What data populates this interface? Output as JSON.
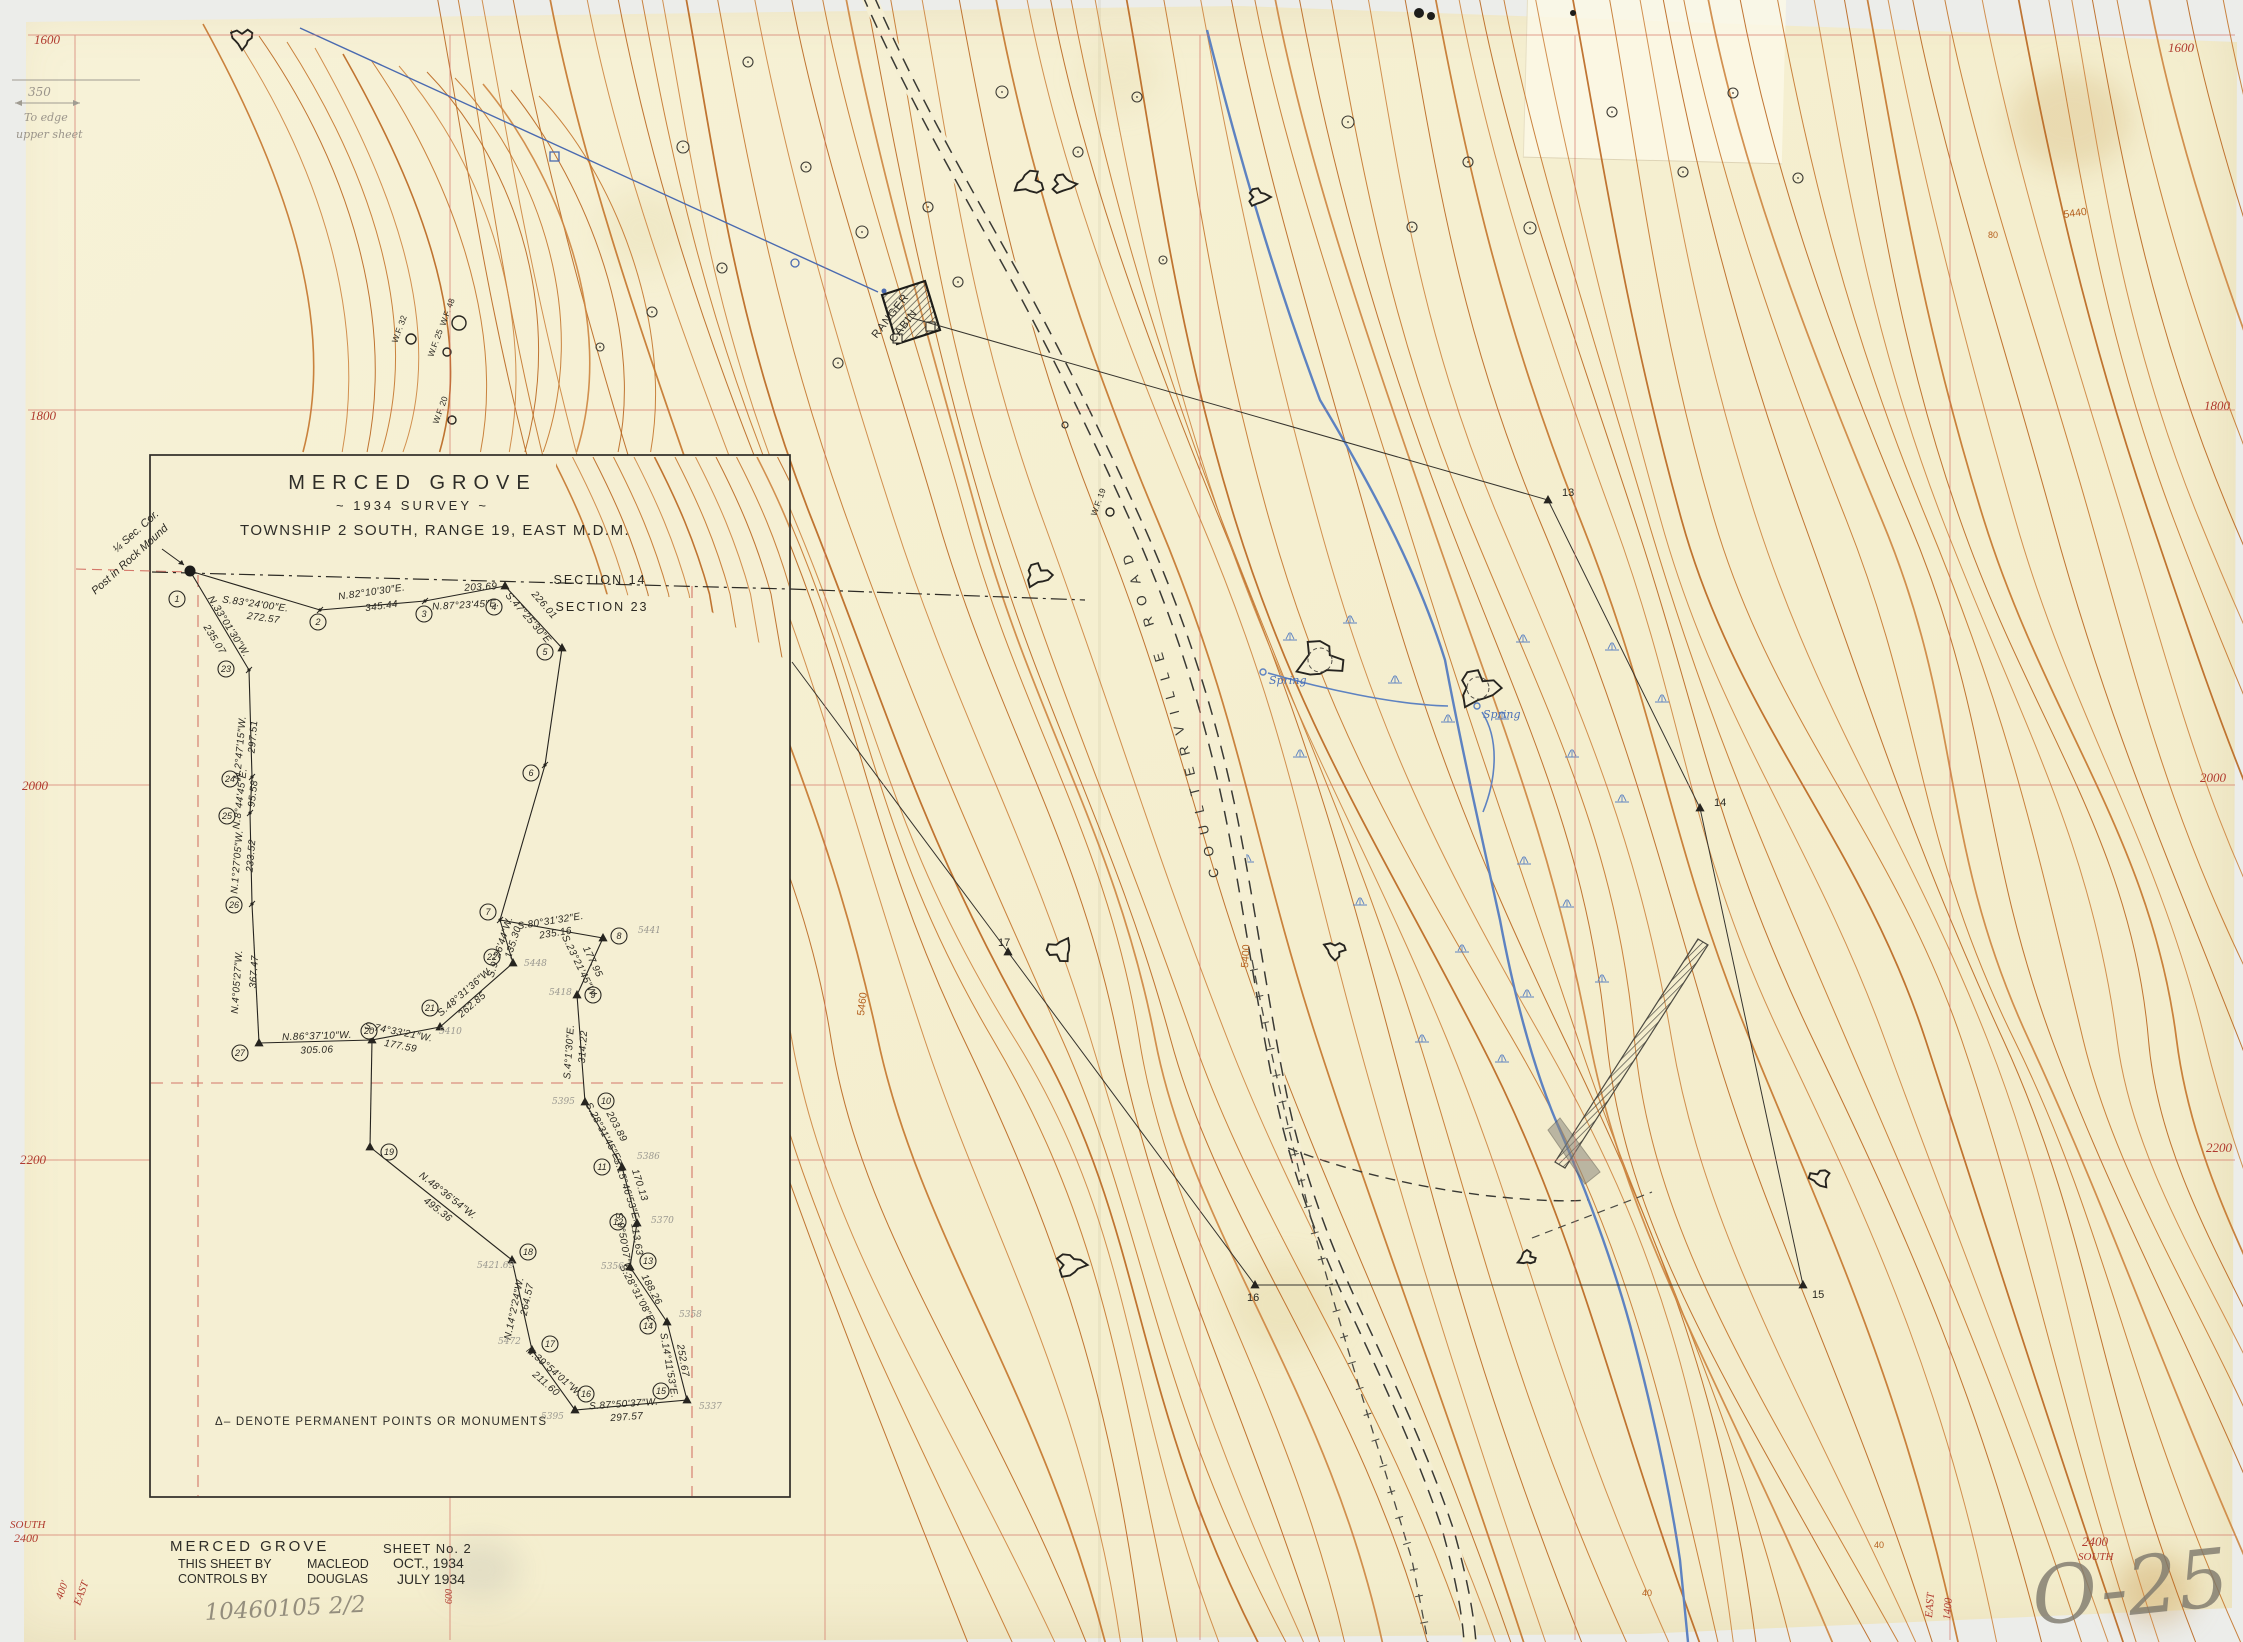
{
  "page": {
    "width": 2243,
    "height": 1642,
    "bg": "#ecedea",
    "paper": "#f5efd3"
  },
  "title_block": {
    "line1": "MERCED GROVE",
    "line2": "~ 1934  SURVEY ~",
    "line3": "TOWNSHIP 2 SOUTH, RANGE 19, EAST M.D.M."
  },
  "footer": {
    "name": "MERCED GROVE",
    "sheet": "SHEET No. 2",
    "by_label": "THIS SHEET BY",
    "by_name": "MACLEOD",
    "by_date": "OCT., 1934",
    "controls_label": "CONTROLS BY",
    "controls_name": "DOUGLAS",
    "controls_date": "JULY 1934"
  },
  "legend_note": "Δ– DENOTE  PERMANENT  POINTS  OR  MONUMENTS",
  "corner_note": {
    "l1": "¼ Sec. Cor.",
    "l2": "Post in Rock Mound"
  },
  "section_line": {
    "upper": "SECTION 14",
    "lower": "SECTION 23"
  },
  "road_label": "COULTERVILLE  ROAD",
  "cabin_label": {
    "l1": "RANGER",
    "l2": "CABIN"
  },
  "spring_label": "Spring",
  "pencil_notes": {
    "plate": "O-25",
    "file": "10460105 2/2",
    "edge1": "350",
    "edge2": "To edge",
    "edge3": "upper sheet"
  },
  "colors": {
    "contour": [
      "#c4762c",
      "#cd8540",
      "#b9661f"
    ],
    "grid_red": "#cf6357",
    "label_red": "#b03a2e",
    "ink": "#2a2822",
    "water_blue": "#5d82c1",
    "pencil": "#8f8a80",
    "contour_label": "#b45f1d"
  },
  "grid_labels": [
    {
      "t": "1600",
      "x": 34,
      "y": 44
    },
    {
      "t": "1600",
      "x": 2168,
      "y": 52
    },
    {
      "t": "1800",
      "x": 30,
      "y": 420
    },
    {
      "t": "1800",
      "x": 2204,
      "y": 410
    },
    {
      "t": "2000",
      "x": 22,
      "y": 790
    },
    {
      "t": "2000",
      "x": 2200,
      "y": 782
    },
    {
      "t": "2200",
      "x": 20,
      "y": 1164
    },
    {
      "t": "2200",
      "x": 2206,
      "y": 1152
    },
    {
      "t": "SOUTH",
      "x": 10,
      "y": 1528,
      "s": 11
    },
    {
      "t": "2400",
      "x": 14,
      "y": 1542,
      "s": 12
    },
    {
      "t": "2400",
      "x": 2082,
      "y": 1546
    },
    {
      "t": "SOUTH",
      "x": 2078,
      "y": 1560,
      "s": 11
    },
    {
      "t": "600",
      "x": 452,
      "y": 1604,
      "r": -90,
      "s": 10
    },
    {
      "t": "400'",
      "x": 62,
      "y": 1600,
      "r": -70,
      "s": 11
    },
    {
      "t": "EAST",
      "x": 80,
      "y": 1606,
      "r": -70,
      "s": 11
    },
    {
      "t": "EAST",
      "x": 1932,
      "y": 1618,
      "r": -85,
      "s": 11
    },
    {
      "t": "1400",
      "x": 1950,
      "y": 1620,
      "r": -85,
      "s": 11
    }
  ],
  "contour_labels": [
    {
      "t": "5440",
      "x": 2064,
      "y": 218,
      "r": -8
    },
    {
      "t": "80",
      "x": 1988,
      "y": 238,
      "s": 9
    },
    {
      "t": "40",
      "x": 1642,
      "y": 1596,
      "s": 9
    },
    {
      "t": "40",
      "x": 1874,
      "y": 1548,
      "s": 9
    },
    {
      "t": "5460",
      "x": 864,
      "y": 1016,
      "r": -83
    },
    {
      "t": "5400",
      "x": 1248,
      "y": 968,
      "r": -86
    }
  ],
  "inset": {
    "segments": [
      {
        "b": "S.83°24'00″E.",
        "d": "272.57",
        "bx": 255,
        "by": 607,
        "br": 8,
        "dx": 263,
        "dy": 621,
        "dr": 8
      },
      {
        "b": "N.82°10'30″E.",
        "d": "345.44",
        "bx": 372,
        "by": 595,
        "br": -8,
        "dx": 382,
        "dy": 609,
        "dr": -8
      },
      {
        "b": "N.87°23'45″E.",
        "d": "203.69",
        "bx": 466,
        "by": 608,
        "br": -3,
        "dx": 481,
        "dy": 590,
        "dr": -3
      },
      {
        "b": "S.47°25'30″E.",
        "d": "226.01",
        "bx": 527,
        "by": 621,
        "br": 49,
        "dx": 542,
        "dy": 607,
        "dr": 49
      },
      {
        "b": "N.33°01'30″W.",
        "d": "235.07",
        "bx": 226,
        "by": 628,
        "br": 58,
        "dx": 212,
        "dy": 641,
        "dr": 58
      },
      {
        "b": "N.2°47'15″W.",
        "d": "297.51",
        "bx": 243,
        "by": 748,
        "br": -85,
        "dx": 256,
        "dy": 737,
        "dr": -85
      },
      {
        "b": "N.8°44'45″E.",
        "d": "95.58",
        "bx": 243,
        "by": 799,
        "br": -83,
        "dx": 256,
        "dy": 794,
        "dr": -83
      },
      {
        "b": "N.1°27'05″W.",
        "d": "233.52",
        "bx": 240,
        "by": 862,
        "br": -85,
        "dx": 254,
        "dy": 856,
        "dr": -85
      },
      {
        "b": "N.4°05'27″W.",
        "d": "367.47",
        "bx": 240,
        "by": 982,
        "br": -86,
        "dx": 257,
        "dy": 972,
        "dr": -86
      },
      {
        "b": "N.86°37'10″W.",
        "d": "305.06",
        "bx": 317,
        "by": 1039,
        "br": -2,
        "dx": 317,
        "dy": 1053,
        "dr": -2
      },
      {
        "b": "S.74°33'21″W.",
        "d": "177.59",
        "bx": 398,
        "by": 1035,
        "br": 11,
        "dx": 400,
        "dy": 1049,
        "dr": 11
      },
      {
        "b": "S.48°31'36″W.",
        "d": "262.85",
        "bx": 467,
        "by": 994,
        "br": -41,
        "dx": 474,
        "dy": 1007,
        "dr": -41
      },
      {
        "b": "S.9°26'44″W.",
        "d": "135.30",
        "bx": 503,
        "by": 948,
        "br": -72,
        "dx": 516,
        "dy": 943,
        "dr": -72
      },
      {
        "b": "S.80°31'32″E.",
        "d": "235.16",
        "bx": 551,
        "by": 924,
        "br": -9,
        "dx": 556,
        "dy": 936,
        "dr": -9
      },
      {
        "b": "S.23°21'45″W.",
        "d": "177.95",
        "bx": 577,
        "by": 968,
        "br": 64,
        "dx": 590,
        "dy": 963,
        "dr": 64
      },
      {
        "b": "S.4°1'30″E.",
        "d": "314.22",
        "bx": 572,
        "by": 1052,
        "br": -86,
        "dx": 586,
        "dy": 1047,
        "dr": -86
      },
      {
        "b": "S.28°31'45″E.",
        "d": "203.89",
        "bx": 601,
        "by": 1134,
        "br": 62,
        "dx": 614,
        "dy": 1128,
        "dr": 62
      },
      {
        "b": "S.15°46'53″E.",
        "d": "170.13",
        "bx": 624,
        "by": 1191,
        "br": 72,
        "dx": 637,
        "dy": 1186,
        "dr": 72
      },
      {
        "b": "S.9°50'07″W.",
        "d": "113.63",
        "bx": 621,
        "by": 1244,
        "br": 80,
        "dx": 634,
        "dy": 1240,
        "dr": 80
      },
      {
        "b": "S.28°31'08″E.",
        "d": "188.26",
        "bx": 635,
        "by": 1296,
        "br": 62,
        "dx": 649,
        "dy": 1291,
        "dr": 62
      },
      {
        "b": "S.14°11'53″E.",
        "d": "252.67",
        "bx": 666,
        "by": 1366,
        "br": 80,
        "dx": 680,
        "dy": 1361,
        "dr": 80
      },
      {
        "b": "S.87°50'37″W.",
        "d": "297.57",
        "bx": 624,
        "by": 1407,
        "br": -4,
        "dx": 627,
        "dy": 1420,
        "dr": -4
      },
      {
        "b": "N.39°54'01″W.",
        "d": "211.60",
        "bx": 552,
        "by": 1374,
        "br": 41,
        "dx": 544,
        "dy": 1386,
        "dr": 41
      },
      {
        "b": "N.14°2'24″W.",
        "d": "264.57",
        "bx": 517,
        "by": 1309,
        "br": -78,
        "dx": 530,
        "dy": 1300,
        "dr": -78
      },
      {
        "b": "N.48°36'54″W.",
        "d": "495.36",
        "bx": 446,
        "by": 1198,
        "br": 38,
        "dx": 436,
        "dy": 1212,
        "dr": 38
      }
    ],
    "stations": [
      {
        "n": "1",
        "x": 190,
        "y": 571,
        "m": "blob",
        "lx": 177,
        "ly": 599
      },
      {
        "n": "2",
        "x": 320,
        "y": 610,
        "m": "tick",
        "lx": 318,
        "ly": 622
      },
      {
        "n": "3",
        "x": 425,
        "y": 601,
        "m": "tick",
        "lx": 424,
        "ly": 614
      },
      {
        "n": "4",
        "x": 505,
        "y": 586,
        "m": "tri",
        "lx": 494,
        "ly": 607
      },
      {
        "n": "5",
        "x": 562,
        "y": 648,
        "m": "tri",
        "lx": 545,
        "ly": 652
      },
      {
        "n": "6",
        "x": 545,
        "y": 765,
        "m": "tick",
        "lx": 531,
        "ly": 773
      },
      {
        "n": "7",
        "x": 500,
        "y": 920,
        "m": "tick",
        "lx": 488,
        "ly": 912
      },
      {
        "n": "8",
        "x": 603,
        "y": 938,
        "m": "tri",
        "lx": 619,
        "ly": 936
      },
      {
        "n": "9",
        "x": 577,
        "y": 995,
        "m": "tri",
        "lx": 593,
        "ly": 995
      },
      {
        "n": "10",
        "x": 585,
        "y": 1102,
        "m": "tri",
        "lx": 606,
        "ly": 1101
      },
      {
        "n": "11",
        "x": 622,
        "y": 1167,
        "m": "tri",
        "lx": 602,
        "ly": 1167
      },
      {
        "n": "12",
        "x": 637,
        "y": 1223,
        "m": "tri",
        "lx": 618,
        "ly": 1222
      },
      {
        "n": "13",
        "x": 630,
        "y": 1267,
        "m": "tri",
        "lx": 648,
        "ly": 1261
      },
      {
        "n": "14",
        "x": 667,
        "y": 1322,
        "m": "tri",
        "lx": 648,
        "ly": 1326
      },
      {
        "n": "15",
        "x": 687,
        "y": 1400,
        "m": "tri",
        "lx": 661,
        "ly": 1391
      },
      {
        "n": "16",
        "x": 575,
        "y": 1410,
        "m": "tri",
        "lx": 586,
        "ly": 1394
      },
      {
        "n": "17",
        "x": 532,
        "y": 1350,
        "m": "tri",
        "lx": 550,
        "ly": 1344
      },
      {
        "n": "18",
        "x": 512,
        "y": 1260,
        "m": "tri",
        "lx": 528,
        "ly": 1252
      },
      {
        "n": "19",
        "x": 370,
        "y": 1147,
        "m": "tri",
        "lx": 389,
        "ly": 1152
      },
      {
        "n": "20",
        "x": 372,
        "y": 1040,
        "m": "tri",
        "lx": 369,
        "ly": 1031
      },
      {
        "n": "21",
        "x": 440,
        "y": 1027,
        "m": "tri",
        "lx": 430,
        "ly": 1008
      },
      {
        "n": "22",
        "x": 513,
        "y": 963,
        "m": "tri",
        "lx": 492,
        "ly": 957
      },
      {
        "n": "23",
        "x": 249,
        "y": 670,
        "m": "tick",
        "lx": 226,
        "ly": 669
      },
      {
        "n": "24",
        "x": 252,
        "y": 777,
        "m": "tick",
        "lx": 230,
        "ly": 779
      },
      {
        "n": "25",
        "x": 250,
        "y": 813,
        "m": "tick",
        "lx": 227,
        "ly": 816
      },
      {
        "n": "26",
        "x": 252,
        "y": 904,
        "m": "tick",
        "lx": 234,
        "ly": 905
      },
      {
        "n": "27",
        "x": 259,
        "y": 1043,
        "m": "tri",
        "lx": 240,
        "ly": 1053
      }
    ],
    "elevations": [
      [
        "5441",
        638,
        933
      ],
      [
        "5448",
        524,
        966
      ],
      [
        "5418",
        549,
        995
      ],
      [
        "5410",
        439,
        1034
      ],
      [
        "5472",
        498,
        1344
      ],
      [
        "5395",
        552,
        1104
      ],
      [
        "5386",
        637,
        1159
      ],
      [
        "5370",
        651,
        1223
      ],
      [
        "5356",
        601,
        1269
      ],
      [
        "5358",
        679,
        1317
      ],
      [
        "5337",
        699,
        1409
      ],
      [
        "5395",
        541,
        1419
      ],
      [
        "5421.69",
        477,
        1268
      ]
    ]
  },
  "main_stations": [
    {
      "n": "13",
      "x": 1548,
      "y": 500,
      "lx": 1562,
      "ly": 496
    },
    {
      "n": "14",
      "x": 1700,
      "y": 808,
      "lx": 1714,
      "ly": 806
    },
    {
      "n": "15",
      "x": 1803,
      "y": 1285,
      "lx": 1812,
      "ly": 1298
    },
    {
      "n": "16",
      "x": 1255,
      "y": 1285,
      "lx": 1247,
      "ly": 1301
    },
    {
      "n": "17",
      "x": 1008,
      "y": 952,
      "lx": 998,
      "ly": 946
    }
  ],
  "trees": {
    "labeled": [
      {
        "t": "W.F. 32",
        "cx": 411,
        "cy": 339,
        "cr": 5,
        "tx": 402,
        "ty": 330
      },
      {
        "t": "W.F. 48",
        "cx": 459,
        "cy": 323,
        "cr": 7,
        "tx": 450,
        "ty": 313
      },
      {
        "t": "W.F. 25",
        "cx": 447,
        "cy": 352,
        "cr": 4,
        "tx": 438,
        "ty": 344
      },
      {
        "t": "W.F. 20",
        "cx": 452,
        "cy": 420,
        "cr": 4,
        "tx": 443,
        "ty": 411
      },
      {
        "t": "W.F. 19",
        "cx": 1110,
        "cy": 512,
        "cr": 4,
        "tx": 1101,
        "ty": 503
      }
    ],
    "plain": [
      [
        683,
        147,
        6
      ],
      [
        748,
        62,
        5
      ],
      [
        806,
        167,
        5
      ],
      [
        862,
        232,
        6
      ],
      [
        928,
        207,
        5
      ],
      [
        1002,
        92,
        6
      ],
      [
        1078,
        152,
        5
      ],
      [
        1137,
        97,
        5
      ],
      [
        1348,
        122,
        6
      ],
      [
        1412,
        227,
        5
      ],
      [
        1468,
        162,
        5
      ],
      [
        1530,
        228,
        6
      ],
      [
        1612,
        112,
        5
      ],
      [
        1683,
        172,
        5
      ],
      [
        838,
        363,
        5
      ],
      [
        958,
        282,
        5
      ],
      [
        722,
        268,
        5
      ],
      [
        652,
        312,
        5
      ],
      [
        600,
        347,
        4
      ],
      [
        1163,
        260,
        4
      ],
      [
        1733,
        93,
        5
      ],
      [
        1798,
        178,
        5
      ]
    ]
  },
  "outcrops": [
    [
      242,
      38,
      12,
      0
    ],
    [
      1030,
      183,
      15,
      0
    ],
    [
      1063,
      184,
      12,
      0
    ],
    [
      1258,
      197,
      11,
      0
    ],
    [
      747,
      505,
      13,
      0
    ],
    [
      1038,
      575,
      14,
      0
    ],
    [
      1320,
      660,
      24,
      1
    ],
    [
      1478,
      688,
      22,
      1
    ],
    [
      1060,
      950,
      14,
      0
    ],
    [
      1335,
      950,
      11,
      0
    ],
    [
      1070,
      1265,
      15,
      0
    ],
    [
      1820,
      1178,
      11,
      0
    ],
    [
      1527,
      1258,
      9,
      0
    ]
  ],
  "springs": [
    [
      1263,
      672
    ],
    [
      1477,
      706
    ]
  ],
  "marsh": [
    [
      1290,
      640
    ],
    [
      1350,
      623
    ],
    [
      1523,
      642
    ],
    [
      1612,
      650
    ],
    [
      1662,
      702
    ],
    [
      1572,
      757
    ],
    [
      1448,
      722
    ],
    [
      1395,
      683
    ],
    [
      1502,
      719
    ],
    [
      1622,
      802
    ],
    [
      1524,
      864
    ],
    [
      1567,
      907
    ],
    [
      1462,
      952
    ],
    [
      1527,
      997
    ],
    [
      1602,
      982
    ],
    [
      1422,
      1042
    ],
    [
      1502,
      1062
    ],
    [
      1247,
      862
    ],
    [
      1360,
      905
    ],
    [
      1300,
      757
    ]
  ]
}
